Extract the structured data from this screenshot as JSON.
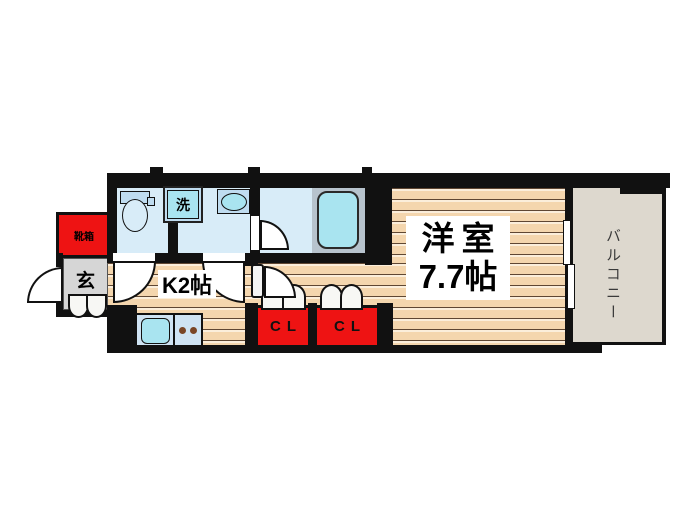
{
  "floorplan": {
    "rooms": {
      "western_room": {
        "label_line1": "洋室",
        "label_line2": "7.7帖"
      },
      "kitchen": {
        "label": "K2帖"
      },
      "balcony": {
        "label": "バルコニー"
      },
      "entrance": {
        "label": "玄"
      },
      "shoe_box": {
        "label": "靴箱"
      },
      "washer": {
        "label": "洗"
      },
      "closet1": {
        "label": "CL"
      },
      "closet2": {
        "label": "CL"
      }
    },
    "colors": {
      "wall": "#111111",
      "water": "#d8ecf8",
      "fixture": "#a9e4f0",
      "fixture2": "#bfdcf0",
      "tub_surround": "#b7c3cd",
      "red": "#ee1313",
      "entrance_gray": "#d6d6d6",
      "balcony": "#ddd8ce",
      "wood": "#f4d6ae",
      "wood_line_dark": "#5f4733",
      "wood_line_light": "#fbeedb",
      "counter": "#cfe3f3",
      "burner": "#7a4526"
    }
  }
}
